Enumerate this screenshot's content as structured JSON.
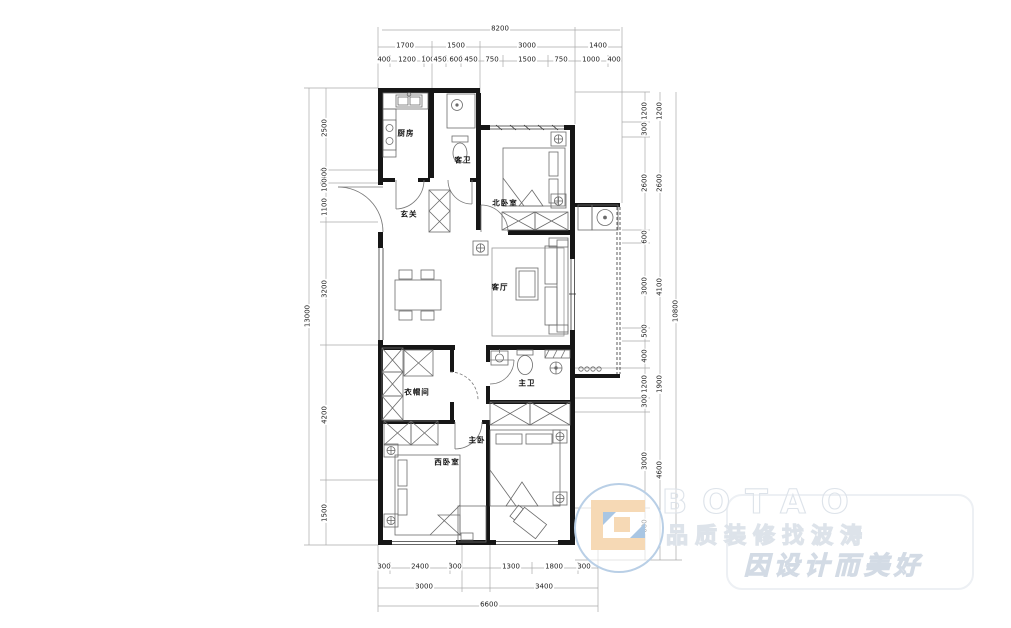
{
  "rooms": {
    "kitchen": "厨房",
    "guest_bath": "客卫",
    "north_bedroom": "北卧室",
    "foyer": "玄关",
    "living_room": "客厅",
    "cloakroom": "衣帽间",
    "master_bath": "主卫",
    "master_bedroom": "主卧",
    "west_bedroom": "西卧室"
  },
  "dimensions": {
    "top_overall": "8200",
    "top_groups": [
      "1700",
      "1500",
      "3000",
      "1400"
    ],
    "top_details": [
      "400",
      "1200",
      "100",
      "450",
      "600",
      "450",
      "750",
      "1500",
      "750",
      "1000",
      "400"
    ],
    "left_overall": "13000",
    "left_details": [
      "2500",
      "400",
      "100",
      "1100",
      "3200",
      "4200",
      "1500"
    ],
    "right_overall": "10800",
    "right_mid": [
      "1200",
      "2600",
      "4100",
      "1900",
      "4600"
    ],
    "right_details": [
      "1200",
      "300",
      "2600",
      "600",
      "3000",
      "500",
      "400",
      "1200",
      "300",
      "3000",
      "600"
    ],
    "bottom_overall": "6600",
    "bottom_groups": [
      "3000",
      "3400"
    ],
    "bottom_details": [
      "300",
      "2400",
      "300",
      "1300",
      "1800",
      "300"
    ]
  },
  "watermark": {
    "brand": "BOTAO",
    "tagline1": "品质装修找波涛",
    "tagline2": "因设计而美好",
    "accent_blue": "#a9c6e3",
    "accent_peach": "#f6d9b5"
  },
  "colors": {
    "wall": "#161616",
    "furniture_line": "#6b6b6b",
    "dimension_line": "#aaaaaa"
  }
}
